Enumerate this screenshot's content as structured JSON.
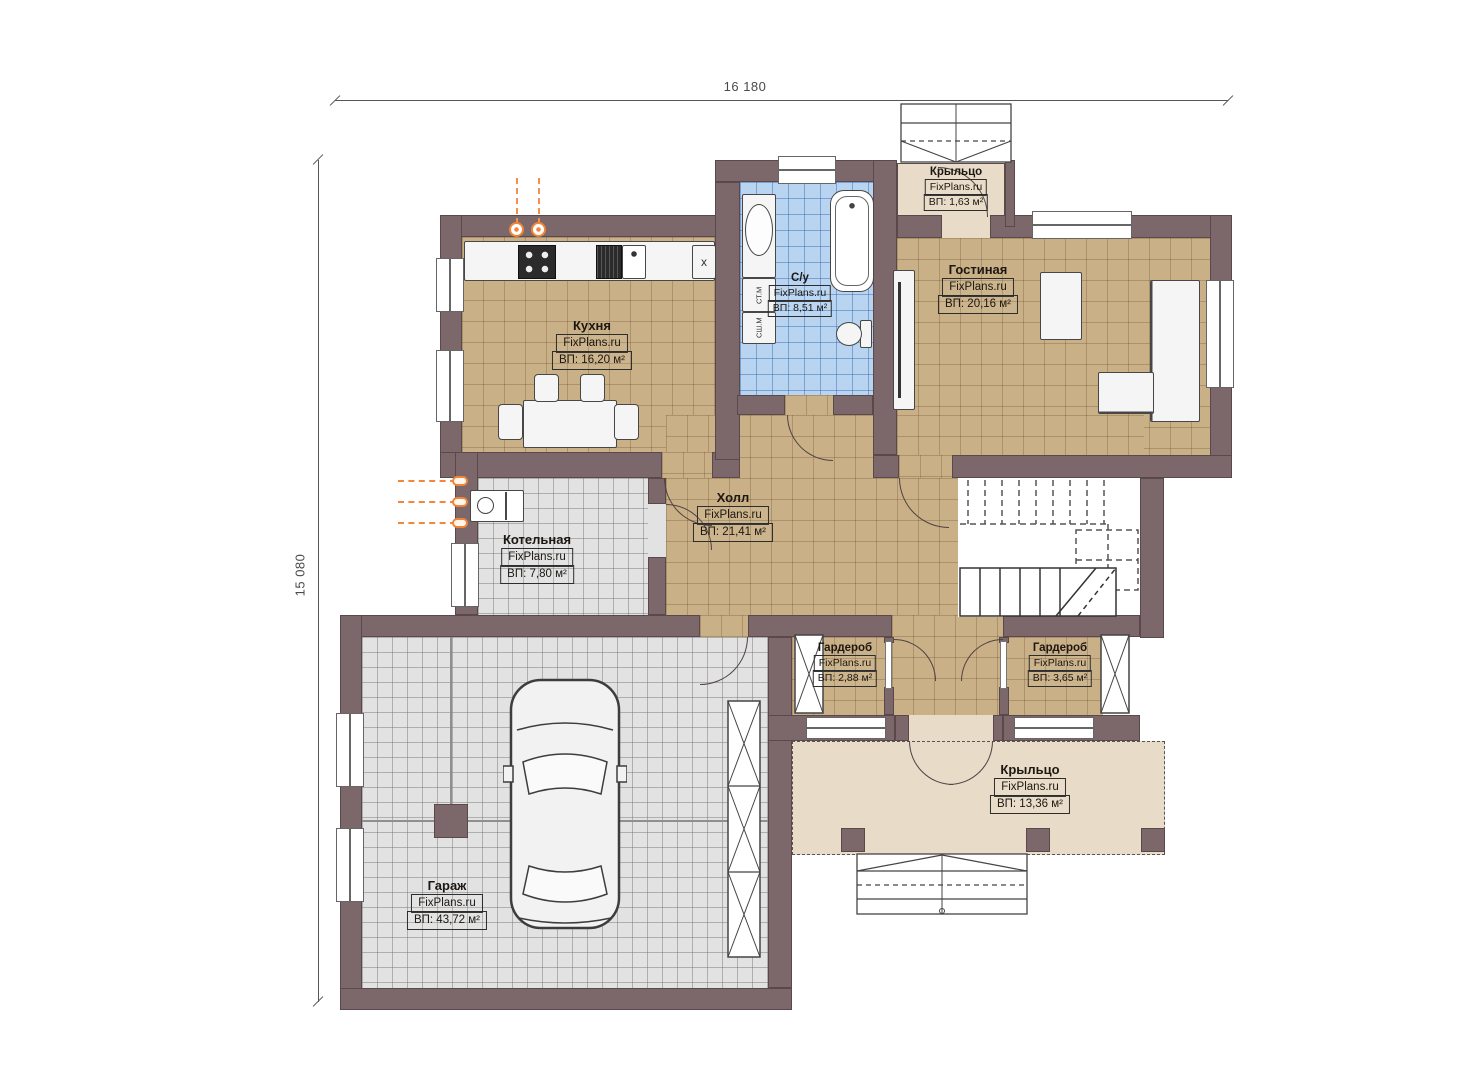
{
  "dimensions": {
    "top": "16 180",
    "left": "15 080"
  },
  "rooms": {
    "kitchen": {
      "name": "Кухня",
      "watermark": "FixPlans.ru",
      "area": "ВП: 16,20 м²"
    },
    "bathroom": {
      "name": "С/у",
      "watermark": "FixPlans.ru",
      "area": "ВП: 8,51 м²"
    },
    "living": {
      "name": "Гостиная",
      "watermark": "FixPlans.ru",
      "area": "ВП: 20,16 м²"
    },
    "hall": {
      "name": "Холл",
      "watermark": "FixPlans.ru",
      "area": "ВП: 21,41 м²"
    },
    "boiler": {
      "name": "Котельная",
      "watermark": "FixPlans.ru",
      "area": "ВП: 7,80 м²"
    },
    "wardrobe_left": {
      "name": "Гардероб",
      "watermark": "FixPlans.ru",
      "area": "ВП: 2,88 м²"
    },
    "wardrobe_right": {
      "name": "Гардероб",
      "watermark": "FixPlans.ru",
      "area": "ВП: 3,65 м²"
    },
    "garage": {
      "name": "Гараж",
      "watermark": "FixPlans.ru",
      "area": "ВП: 43,72 м²"
    },
    "porch_top": {
      "name": "Крыльцо",
      "watermark": "FixPlans.ru",
      "area": "ВП: 1,63 м²"
    },
    "porch_bottom": {
      "name": "Крыльцо",
      "watermark": "FixPlans.ru",
      "area": "ВП: 13,36 м²"
    }
  },
  "appliances": {
    "washing_machine": "СТ.М",
    "dryer": "СШ.М",
    "counter_mark": "x"
  },
  "colors": {
    "wall": "#7c686a",
    "floor_wood": "#cab086",
    "floor_tile_blue": "#b9d4f1",
    "floor_tile_gray": "#e2e2e2",
    "porch": "#e8dcc8",
    "pipe_accent": "#f08438"
  }
}
